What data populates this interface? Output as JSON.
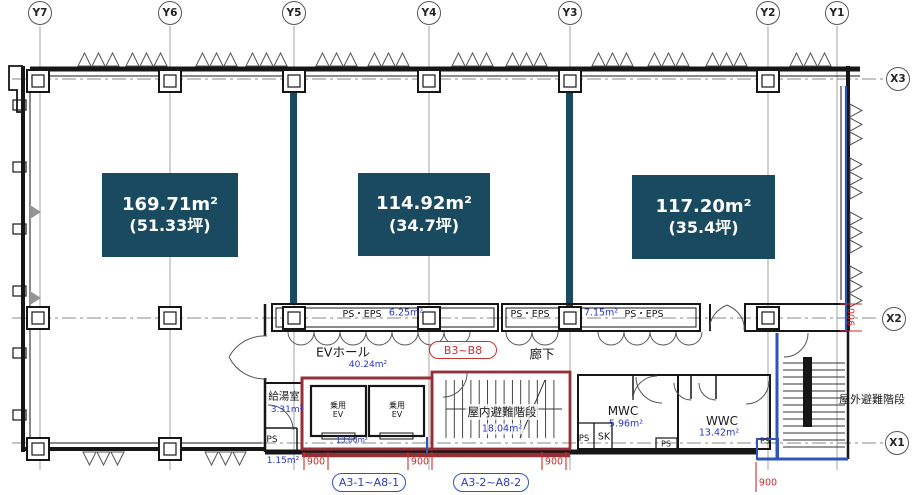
{
  "drawing": {
    "grid": {
      "y_axes": [
        "Y7",
        "Y6",
        "Y5",
        "Y4",
        "Y3",
        "Y2",
        "Y1"
      ],
      "x_axes": [
        "X3",
        "X2",
        "X1"
      ]
    },
    "units": [
      {
        "area_m2": "169.71m²",
        "area_tsubo": "(51.33坪)"
      },
      {
        "area_m2": "114.92m²",
        "area_tsubo": "(34.7坪)"
      },
      {
        "area_m2": "117.20m²",
        "area_tsubo": "(35.4坪)"
      }
    ],
    "rooms": {
      "ps_eps_1": {
        "name": "PS・EPS",
        "area": "6.25m²"
      },
      "ps_eps_2": {
        "name_left": "PS・EPS",
        "area": "7.15m²",
        "name_right": "PS・EPS"
      },
      "ev_hall": {
        "name": "EVホール",
        "area": "40.24m²"
      },
      "corridor": {
        "name": "廊下"
      },
      "kitchenette": {
        "name": "給湯室",
        "area": "3.31m²"
      },
      "elevator_1": {
        "line1": "乗用",
        "line2": "EV"
      },
      "elevator_2": {
        "line1": "乗用",
        "line2": "EV"
      },
      "elevator_area": "13.60m²",
      "indoor_stairs": {
        "name": "屋内避難階段",
        "area": "18.04m²"
      },
      "mwc": {
        "name": "MWC",
        "area": "5.96m²"
      },
      "sk": {
        "name": "SK"
      },
      "ps_left": {
        "name": "PS"
      },
      "ps_mid": {
        "name": "PS"
      },
      "ps_right": {
        "name": "PS"
      },
      "ps_bottom": {
        "name": "PS",
        "area": "1.15m²"
      },
      "wwc": {
        "name": "WWC",
        "area": "13.42m²"
      },
      "outdoor_stairs": {
        "name": "屋外避難階段"
      }
    },
    "tags": {
      "b_units": "B3~B8",
      "a_units_1": "A3-1~A8-1",
      "a_units_2": "A3-2~A8-2"
    },
    "dimensions": {
      "d1": "900",
      "d2": "900",
      "d3": "900",
      "d4": "900",
      "right": "900"
    },
    "colors": {
      "unit_fill": "#1a4a5f",
      "area_text": "#2636cc",
      "dim_red": "#d02a2a",
      "core_red": "#943038",
      "core_blue": "#2f55b8"
    }
  }
}
